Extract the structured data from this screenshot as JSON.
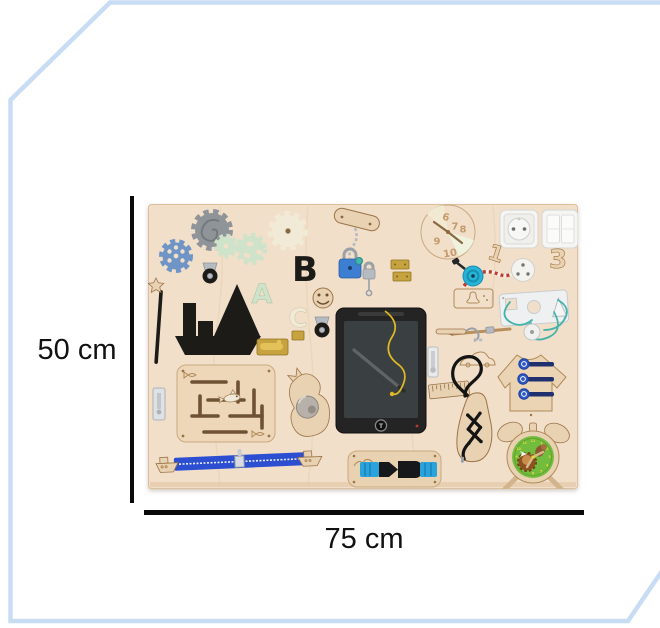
{
  "dimension_annotation": {
    "height_label": "50 cm",
    "width_label": "75 cm"
  },
  "board": {
    "letters": {
      "a": "A",
      "b": "B",
      "c": "C"
    },
    "wooden_numbers": {
      "one": "1",
      "three": "3"
    },
    "spinner_numbers": [
      "6",
      "7",
      "8",
      "9",
      "10"
    ],
    "alarm_clock_numbers": [
      "12",
      "1",
      "2",
      "3",
      "4",
      "5",
      "6",
      "7",
      "8",
      "9",
      "10",
      "11"
    ],
    "tablet_button_label": "T",
    "items": [
      "gear-set",
      "magic-wand",
      "ship-silhouette",
      "caster-wheels",
      "letter-a",
      "letter-b",
      "letter-c",
      "smiley-face",
      "chain-with-blue-padlock",
      "padlock-with-key",
      "brass-hinges",
      "barrel-bolt",
      "number-spinner-clock",
      "power-socket",
      "double-light-switch",
      "wooden-number-1",
      "wooden-number-3",
      "plug-with-striped-cord",
      "bell",
      "bell-engraving",
      "shape-lacing-plate",
      "lacing-cord",
      "wooden-disc",
      "wooden-spear",
      "car-engraving",
      "lcd-writing-tablet",
      "stylus",
      "slide-bolt",
      "wooden-ruler",
      "stick-with-hook",
      "shark-maze",
      "whale-with-mirror",
      "left-slide-bolt",
      "zipper-with-boats",
      "buckle-board",
      "lacing-shoe",
      "button-t-shirt",
      "alarm-clock"
    ]
  },
  "colors": {
    "bg": "#ffffff",
    "frame-blue": "#c8dcf4",
    "dim-line": "#0a0a0a",
    "dim-text": "#111111",
    "wood": "#f2dfca",
    "wood-mid": "#e9d2b2",
    "wood-dark": "#d3b48c",
    "wood-line": "#9a7448",
    "groove": "#6f5233",
    "ink": "#1d1b18",
    "mint": "#cfe2ca",
    "cream": "#f0ead7",
    "gear-blue": "#6e95c5",
    "gear-gray": "#8f9499",
    "brass": "#c7a33f",
    "brass-light": "#e3c25a",
    "silver": "#b6bbc1",
    "lock-blue": "#3c7ed2",
    "bell-cyan": "#27b2d6",
    "zip-blue": "#2c4fd2",
    "buckle-cyan": "#2aa2db",
    "teal": "#43b3ab",
    "navy": "#20306e",
    "button-blue": "#2e58c4",
    "clock-green": "#72bc3e",
    "clock-yellow": "#e9d83e",
    "cord-yellow": "#e0ba25",
    "cord-red": "#c23b2e",
    "white": "#f5f5f3",
    "screen": "#3a3f41"
  }
}
